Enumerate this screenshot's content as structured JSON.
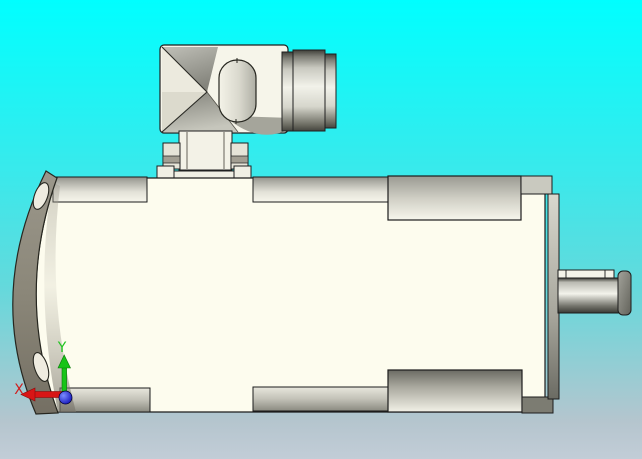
{
  "viewport": {
    "kind": "cad-3d-view",
    "visible_model": "electric motor with right-angle connector, mounting flange and keyed output shaft"
  },
  "axis_triad": {
    "x_label": "X",
    "y_label": "Y",
    "x_color": "#d81616",
    "y_color": "#18c418",
    "z_color": "#1515bb"
  },
  "background": {
    "top_color": "#00ffff",
    "bottom_color": "#c2cdd7"
  },
  "model_colors": {
    "body": "#fdfcee",
    "flange_metal": "#8b8779",
    "outline": "#1c1c1c"
  }
}
